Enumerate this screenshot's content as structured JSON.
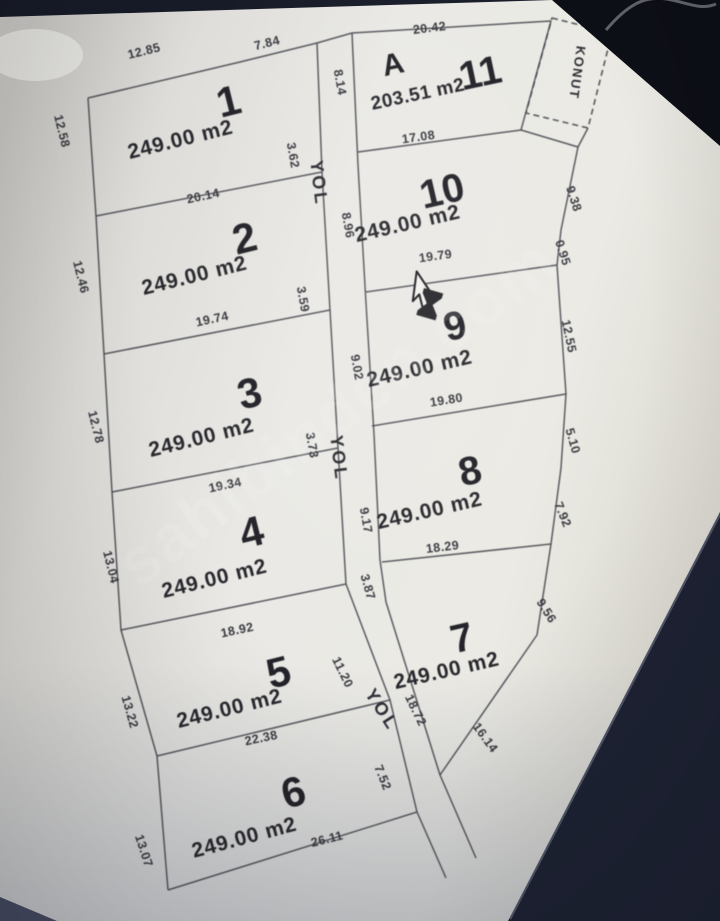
{
  "watermark": "sahibinden.com",
  "plan": {
    "konut": {
      "label": "KONUT"
    },
    "roads": [
      {
        "label": "YOL"
      },
      {
        "label": "YOL"
      },
      {
        "label": "YOL"
      }
    ],
    "parcels": [
      {
        "number": "1",
        "area": "249.00 m2"
      },
      {
        "number": "2",
        "area": "249.00 m2"
      },
      {
        "number": "3",
        "area": "249.00 m2"
      },
      {
        "number": "4",
        "area": "249.00 m2"
      },
      {
        "number": "5",
        "area": "249.00 m2"
      },
      {
        "number": "6",
        "area": "249.00 m2"
      },
      {
        "number": "7",
        "area": "249.00 m2"
      },
      {
        "number": "8",
        "area": "249.00 m2"
      },
      {
        "number": "9",
        "area": "249.00 m2"
      },
      {
        "number": "10",
        "area": "249.00 m2"
      },
      {
        "number": "11",
        "block": "A",
        "area": "203.51 m2"
      }
    ],
    "measurements": [
      {
        "edge": "parcel1-top-left",
        "value": "12.85"
      },
      {
        "edge": "parcel1-top-right",
        "value": "7.84"
      },
      {
        "edge": "parcel1-left",
        "value": "12.58"
      },
      {
        "edge": "parcel1-road",
        "value": "3.62"
      },
      {
        "edge": "parcel1-parcel2",
        "value": "20.14"
      },
      {
        "edge": "parcel2-left",
        "value": "12.46"
      },
      {
        "edge": "parcel2-road",
        "value": "3.59"
      },
      {
        "edge": "parcel2-parcel3",
        "value": "19.74"
      },
      {
        "edge": "parcel3-left",
        "value": "12.78"
      },
      {
        "edge": "parcel3-road",
        "value": "3.73"
      },
      {
        "edge": "parcel3-parcel4",
        "value": "19.34"
      },
      {
        "edge": "parcel4-left",
        "value": "13.04"
      },
      {
        "edge": "parcel4-parcel5",
        "value": "18.92"
      },
      {
        "edge": "parcel5-left",
        "value": "13.22"
      },
      {
        "edge": "parcel5-road",
        "value": "11.20"
      },
      {
        "edge": "parcel5-parcel6",
        "value": "22.38"
      },
      {
        "edge": "parcel6-left",
        "value": "13.07"
      },
      {
        "edge": "parcel6-bottom",
        "value": "26.11"
      },
      {
        "edge": "parcel6-road",
        "value": "7.52"
      },
      {
        "edge": "parcel11-top",
        "value": "20.42"
      },
      {
        "edge": "parcel11-road",
        "value": "8.14"
      },
      {
        "edge": "parcel11-parcel10",
        "value": "17.08"
      },
      {
        "edge": "parcel10-road",
        "value": "8.96"
      },
      {
        "edge": "parcel10-right-upper",
        "value": "9.38"
      },
      {
        "edge": "parcel10-right-lower",
        "value": "0.95"
      },
      {
        "edge": "parcel10-parcel9",
        "value": "19.79"
      },
      {
        "edge": "parcel9-road",
        "value": "9.02"
      },
      {
        "edge": "parcel9-right",
        "value": "12.55"
      },
      {
        "edge": "parcel9-parcel8",
        "value": "19.80"
      },
      {
        "edge": "parcel8-road",
        "value": "9.17"
      },
      {
        "edge": "parcel8-right-upper",
        "value": "5.10"
      },
      {
        "edge": "parcel8-right-lower",
        "value": "7.92"
      },
      {
        "edge": "parcel8-parcel7",
        "value": "18.29"
      },
      {
        "edge": "road-segment",
        "value": "3.87"
      },
      {
        "edge": "parcel7-road",
        "value": "18.72"
      },
      {
        "edge": "parcel7-right",
        "value": "9.56"
      },
      {
        "edge": "parcel7-bottom",
        "value": "16.14"
      }
    ]
  }
}
